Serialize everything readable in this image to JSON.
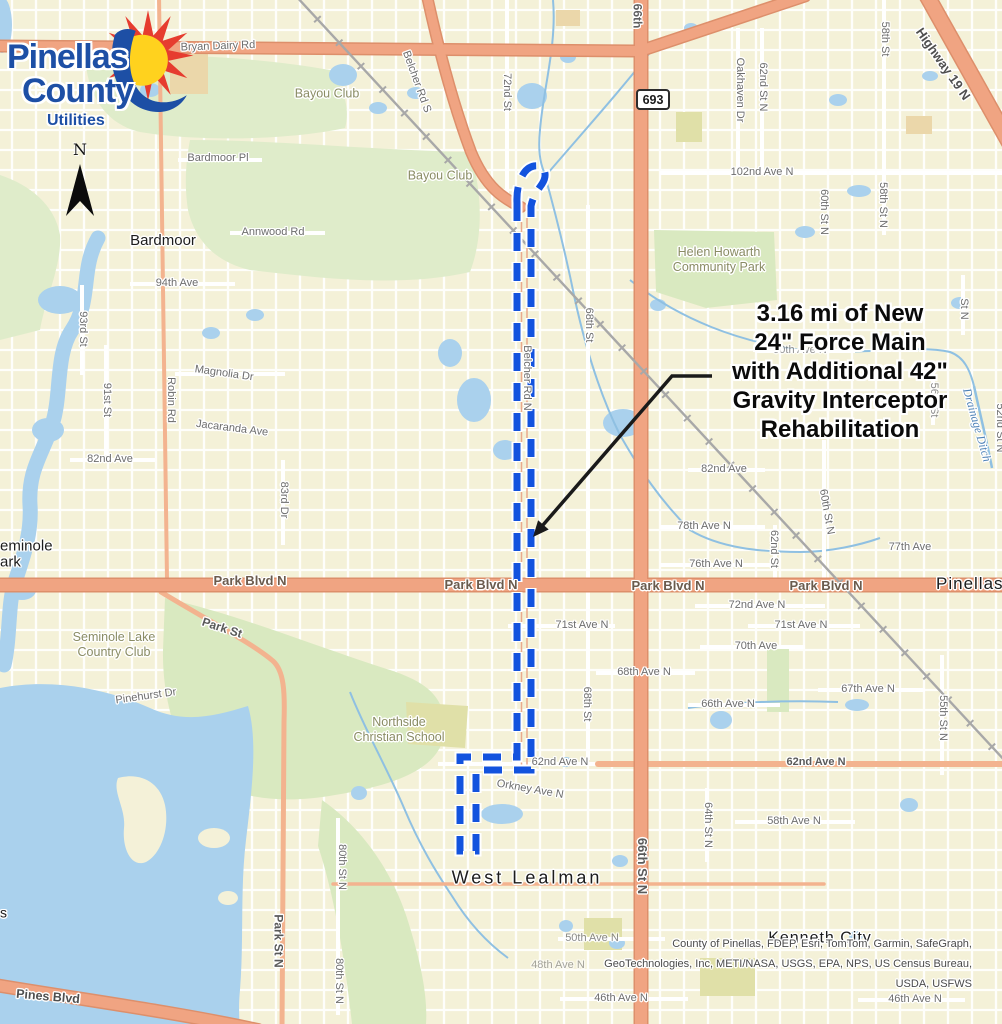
{
  "map": {
    "logo": {
      "name_line1": "Pinellas",
      "name_line2": "County",
      "department": "Utilities"
    },
    "north_arrow_label": "N",
    "highway_shield": "693",
    "annotation": {
      "lines": [
        "3.16 mi of New",
        "24\" Force Main",
        "with Additional 42\"",
        "Gravity Interceptor",
        "Rehabilitation"
      ]
    },
    "attribution_lines": [
      "County of Pinellas, FDEP, Esri, TomTom, Garmin, SafeGraph,",
      "GeoTechnologies, Inc, METI/NASA, USGS, EPA, NPS, US Census Bureau,",
      "USDA, USFWS"
    ],
    "place_labels": [
      {
        "t": "Bardmoor",
        "x": 163,
        "y": 241,
        "size": 15
      },
      {
        "t": "West Lealman",
        "x": 527,
        "y": 878,
        "size": 18,
        "ls": 3
      },
      {
        "t": "Kenneth City",
        "x": 820,
        "y": 939,
        "size": 16,
        "ls": 1
      },
      {
        "t": "Pinellas Park",
        "x": 936,
        "y": 584,
        "size": 17,
        "ls": 1,
        "align": "left"
      },
      {
        "t": "Seminole\nPark",
        "x": -10,
        "y": 554,
        "size": 15,
        "align": "left"
      },
      {
        "t": "s",
        "x": 0,
        "y": 913,
        "size": 14,
        "align": "left"
      }
    ],
    "area_labels": [
      {
        "t": "Bayou Club",
        "x": 327,
        "y": 94
      },
      {
        "t": "Bayou Club",
        "x": 440,
        "y": 176
      },
      {
        "t": "Seminole Lake\nCountry Club",
        "x": 114,
        "y": 645
      },
      {
        "t": "Northside\nChristian School",
        "x": 399,
        "y": 730
      },
      {
        "t": "Helen Howarth\nCommunity Park",
        "x": 719,
        "y": 260
      }
    ],
    "water_labels": [
      {
        "t": "Drainage Ditch",
        "x": 977,
        "y": 425,
        "rot": 74
      }
    ],
    "street_labels": [
      {
        "t": "Bryan Dairy Rd",
        "x": 218,
        "y": 47,
        "rot": -2
      },
      {
        "t": "Bardmoor Pl",
        "x": 218,
        "y": 159
      },
      {
        "t": "Annwood Rd",
        "x": 273,
        "y": 233
      },
      {
        "t": "94th Ave",
        "x": 177,
        "y": 284
      },
      {
        "t": "Magnolia Dr",
        "x": 224,
        "y": 374,
        "rot": 8
      },
      {
        "t": "Jacaranda Ave",
        "x": 232,
        "y": 429,
        "rot": 7
      },
      {
        "t": "82nd Ave",
        "x": 110,
        "y": 460
      },
      {
        "t": "93rd St",
        "x": 82,
        "y": 329,
        "rot": 90
      },
      {
        "t": "91st St",
        "x": 106,
        "y": 400,
        "rot": 90
      },
      {
        "t": "Robin Rd",
        "x": 170,
        "y": 400,
        "rot": 90
      },
      {
        "t": "83rd Dr",
        "x": 283,
        "y": 500,
        "rot": 90
      },
      {
        "t": "Belcher Rd S",
        "x": 416,
        "y": 82,
        "rot": 70
      },
      {
        "t": "72nd St",
        "x": 506,
        "y": 92,
        "rot": 90
      },
      {
        "t": "66th",
        "x": 637,
        "y": 16,
        "rot": 90,
        "size": 12,
        "w": "bold",
        "color": "#5f5f5f"
      },
      {
        "t": "Oakhaven Dr",
        "x": 739,
        "y": 90,
        "rot": 90
      },
      {
        "t": "62nd St N",
        "x": 762,
        "y": 87,
        "rot": 90
      },
      {
        "t": "58th St",
        "x": 884,
        "y": 39,
        "rot": 90
      },
      {
        "t": "Highway 19 N",
        "x": 943,
        "y": 64,
        "rot": 55,
        "size": 13,
        "w": "bold",
        "color": "#4f4f4f"
      },
      {
        "t": "102nd Ave N",
        "x": 762,
        "y": 173
      },
      {
        "t": "58th St N",
        "x": 882,
        "y": 205,
        "rot": 90
      },
      {
        "t": "60th St N",
        "x": 823,
        "y": 212,
        "rot": 90
      },
      {
        "t": "90th Ave N",
        "x": 800,
        "y": 351,
        "op": 0.75
      },
      {
        "t": "St N",
        "x": 963,
        "y": 309,
        "rot": 90
      },
      {
        "t": "56th St",
        "x": 933,
        "y": 400,
        "rot": 90,
        "op": 0.8
      },
      {
        "t": "52nd St N",
        "x": 999,
        "y": 428,
        "rot": 90
      },
      {
        "t": "Belcher Rd N",
        "x": 526,
        "y": 378,
        "rot": 90
      },
      {
        "t": "68th St",
        "x": 588,
        "y": 325,
        "rot": 90
      },
      {
        "t": "82nd Ave",
        "x": 724,
        "y": 470
      },
      {
        "t": "78th Ave N",
        "x": 704,
        "y": 527
      },
      {
        "t": "76th Ave N",
        "x": 716,
        "y": 565
      },
      {
        "t": "77th Ave",
        "x": 910,
        "y": 548
      },
      {
        "t": "62nd St",
        "x": 773,
        "y": 549,
        "rot": 90
      },
      {
        "t": "60th St N",
        "x": 826,
        "y": 512,
        "rot": 80
      },
      {
        "t": "Park Blvd N",
        "x": 250,
        "y": 581,
        "size": 13,
        "w": "bold",
        "color": "#6b5b4d"
      },
      {
        "t": "Park Blvd N",
        "x": 481,
        "y": 585,
        "size": 13,
        "w": "bold",
        "color": "#6b5b4d"
      },
      {
        "t": "Park Blvd N",
        "x": 668,
        "y": 586,
        "size": 13,
        "w": "bold",
        "color": "#6b5b4d"
      },
      {
        "t": "Park Blvd N",
        "x": 826,
        "y": 586,
        "size": 13,
        "w": "bold",
        "color": "#6b5b4d"
      },
      {
        "t": "Park St",
        "x": 222,
        "y": 628,
        "rot": 18,
        "size": 12,
        "w": "bold",
        "color": "#5a5a5a"
      },
      {
        "t": "72nd Ave N",
        "x": 757,
        "y": 606
      },
      {
        "t": "71st Ave N",
        "x": 801,
        "y": 626
      },
      {
        "t": "71st Ave N",
        "x": 582,
        "y": 626
      },
      {
        "t": "70th Ave",
        "x": 756,
        "y": 647
      },
      {
        "t": "68th Ave N",
        "x": 644,
        "y": 673
      },
      {
        "t": "67th Ave N",
        "x": 868,
        "y": 690
      },
      {
        "t": "66th Ave N",
        "x": 728,
        "y": 705
      },
      {
        "t": "68th St",
        "x": 586,
        "y": 704,
        "rot": 90
      },
      {
        "t": "55th St N",
        "x": 942,
        "y": 718,
        "rot": 90
      },
      {
        "t": "Pinehurst Dr",
        "x": 146,
        "y": 697,
        "rot": -8
      },
      {
        "t": "62nd Ave N",
        "x": 560,
        "y": 763
      },
      {
        "t": "62nd Ave N",
        "x": 816,
        "y": 763,
        "w": "bold",
        "color": "#5a5a5a"
      },
      {
        "t": "Orkney Ave N",
        "x": 530,
        "y": 790,
        "rot": 10
      },
      {
        "t": "58th Ave N",
        "x": 794,
        "y": 822
      },
      {
        "t": "64th St N",
        "x": 707,
        "y": 825,
        "rot": 90
      },
      {
        "t": "80th St N",
        "x": 341,
        "y": 867,
        "rot": 90
      },
      {
        "t": "66th St N",
        "x": 642,
        "y": 866,
        "rot": 90,
        "size": 13,
        "w": "bold",
        "color": "#5a5a5a"
      },
      {
        "t": "80th St N",
        "x": 338,
        "y": 981,
        "rot": 90
      },
      {
        "t": "Park St N",
        "x": 278,
        "y": 941,
        "rot": 90,
        "size": 12,
        "w": "bold",
        "color": "#5a5a5a"
      },
      {
        "t": "50th Ave N",
        "x": 592,
        "y": 939,
        "op": 0.8
      },
      {
        "t": "48th Ave N",
        "x": 558,
        "y": 966,
        "op": 0.6
      },
      {
        "t": "46th Ave N",
        "x": 621,
        "y": 999
      },
      {
        "t": "46th Ave N",
        "x": 915,
        "y": 1000
      },
      {
        "t": "Pines Blvd",
        "x": 48,
        "y": 997,
        "rot": 5,
        "size": 12.5,
        "w": "bold",
        "color": "#4f4f4f"
      }
    ],
    "colors": {
      "land": "#f4f1d8",
      "water": "#aad1ed",
      "stream": "#8fc0e2",
      "green": "#d9e9c0",
      "green2": "#dfecca",
      "khaki": "#e0e0a8",
      "building": "#ebd7aa",
      "road_major": "#f0a482",
      "road_major_casing": "#dd8f6b",
      "road_minor": "#f3b38f",
      "railroad": "#a8a8a8",
      "route": "#1353de",
      "arrow": "#1a1a1a",
      "label_gray": "#6d6d6d",
      "place_black": "#1c1c1c",
      "area_green": "#8a8c64",
      "water_blue": "#4e82b7",
      "attribution_gray": "#4a4a4a",
      "annotation_black": "#0a0a0a",
      "logo_blue": "#1d4fa5",
      "sun_red": "#e63c2f",
      "sun_yellow": "#ffd21e"
    }
  }
}
